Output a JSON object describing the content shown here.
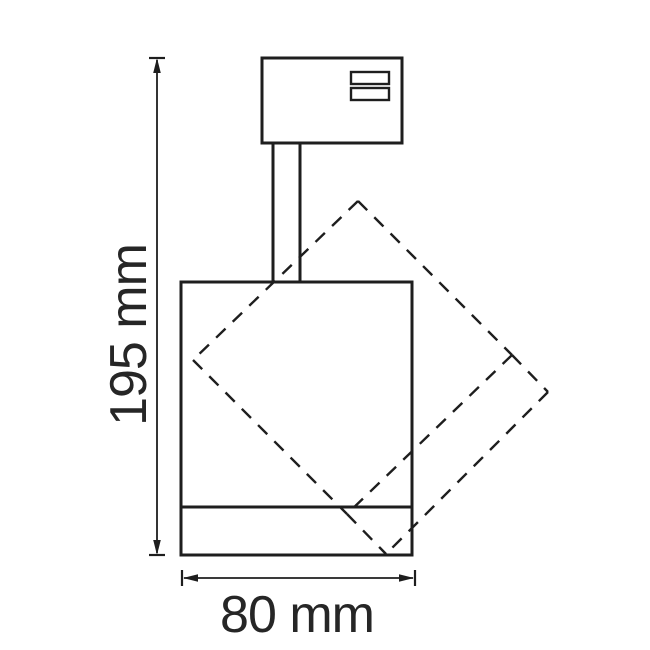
{
  "diagram": {
    "labels": {
      "height": "195 mm",
      "width": "80 mm"
    },
    "values": {
      "height_mm": 195,
      "width_mm": 80
    },
    "colors": {
      "background": "#ffffff",
      "line": "#1e1e1e",
      "text": "#262626"
    }
  }
}
